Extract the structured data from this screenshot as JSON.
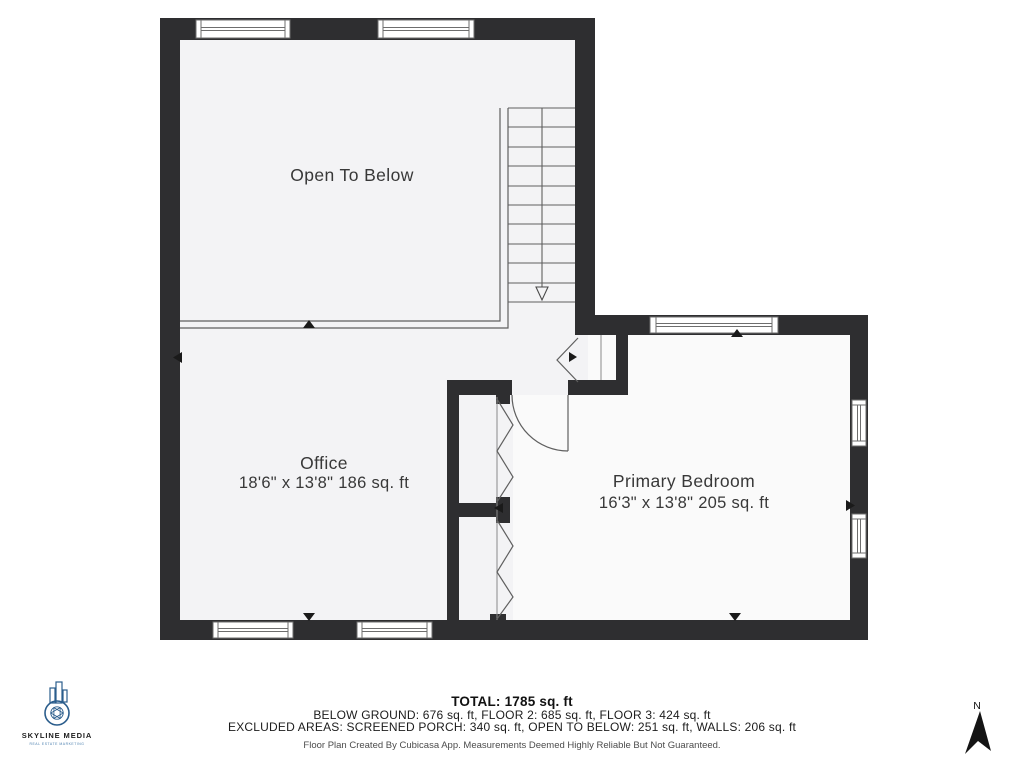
{
  "plan": {
    "rooms": [
      {
        "id": "open_to_below",
        "label": "Open To Below"
      },
      {
        "id": "office",
        "label": "Office",
        "dimensions": "18'6\" x 13'8\" 186 sq. ft"
      },
      {
        "id": "primary_bedroom",
        "label": "Primary Bedroom",
        "dimensions": "16'3\" x 13'8\" 205 sq. ft"
      }
    ],
    "features": [
      "stairs-down",
      "bedroom-door",
      "closet-bifold-doors",
      "windows"
    ]
  },
  "footer": {
    "total": "TOTAL: 1785 sq. ft",
    "floors": "BELOW GROUND: 676 sq. ft, FLOOR 2: 685 sq. ft, FLOOR 3: 424 sq. ft",
    "excluded": "EXCLUDED AREAS: SCREENED PORCH: 340 sq. ft, OPEN TO BELOW: 251 sq. ft, WALLS: 206 sq. ft",
    "disclaimer": "Floor Plan Created By Cubicasa App. Measurements Deemed Highly Reliable But Not Guaranteed."
  },
  "branding": {
    "logo_name": "SKYLINE MEDIA",
    "logo_tagline": "REAL ESTATE MARKETING"
  },
  "compass": {
    "label": "N"
  },
  "colors": {
    "wall": "#2e2e30",
    "room_fill": "#f3f3f5",
    "bedroom_fill": "#fafafa",
    "line": "#5f5f5f",
    "logo_accent": "#2b5d8c"
  }
}
